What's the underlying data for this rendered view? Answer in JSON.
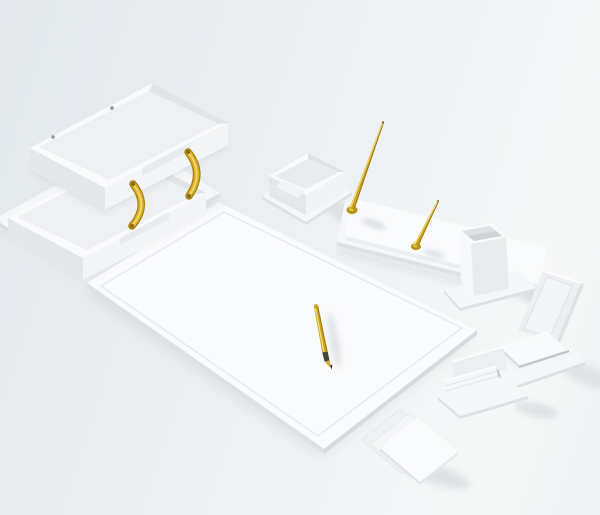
{
  "meta": {
    "type": "product-photo",
    "subject": "White leather desk accessories set with gold accents on a light gray seamless studio background",
    "text_visible": "none"
  },
  "palette": {
    "background_top": "#e3e8ec",
    "background_bottom": "#f2f5f6",
    "white_top": "#fafbfc",
    "white_bright": "#f5f7f9",
    "white_side": "#e4e7ea",
    "white_floor": "#eef0f2",
    "edge": "#dde1e5",
    "interior": "#cfd2d6",
    "shadow": "#c7ced5",
    "gold": "#cfa321",
    "gold_bracket": "#d9af2e",
    "gold_light": "#f0d968",
    "gold_dark": "#977412",
    "gold_deep": "#8a6a10",
    "pen_grip": "#4a4238"
  },
  "items": [
    {
      "id": "desk-pad",
      "label": "Desk pad blotter with inner stitched border and gold fountain pen",
      "pens": 1
    },
    {
      "id": "letter-tray",
      "label": "Two-tier document tray joined by curved gold brackets",
      "tiers": 2,
      "brackets": 2,
      "screw_holes": 2
    },
    {
      "id": "organizer-box",
      "label": "Small desk organizer box on base plate",
      "compartments": 2
    },
    {
      "id": "pen-stand",
      "label": "Double pen stand with two upright gold pens",
      "pens": 2
    },
    {
      "id": "pencil-cup",
      "label": "Square pencil cup on base plate"
    },
    {
      "id": "memo-holder",
      "label": "Memo pad holder with upright back panel and paper stack"
    },
    {
      "id": "card-holder",
      "label": "Two-slot letter and card holder on base plate",
      "slots": 2
    },
    {
      "id": "note-papers",
      "label": "Three fanned square note papers",
      "sheets": 3
    }
  ]
}
